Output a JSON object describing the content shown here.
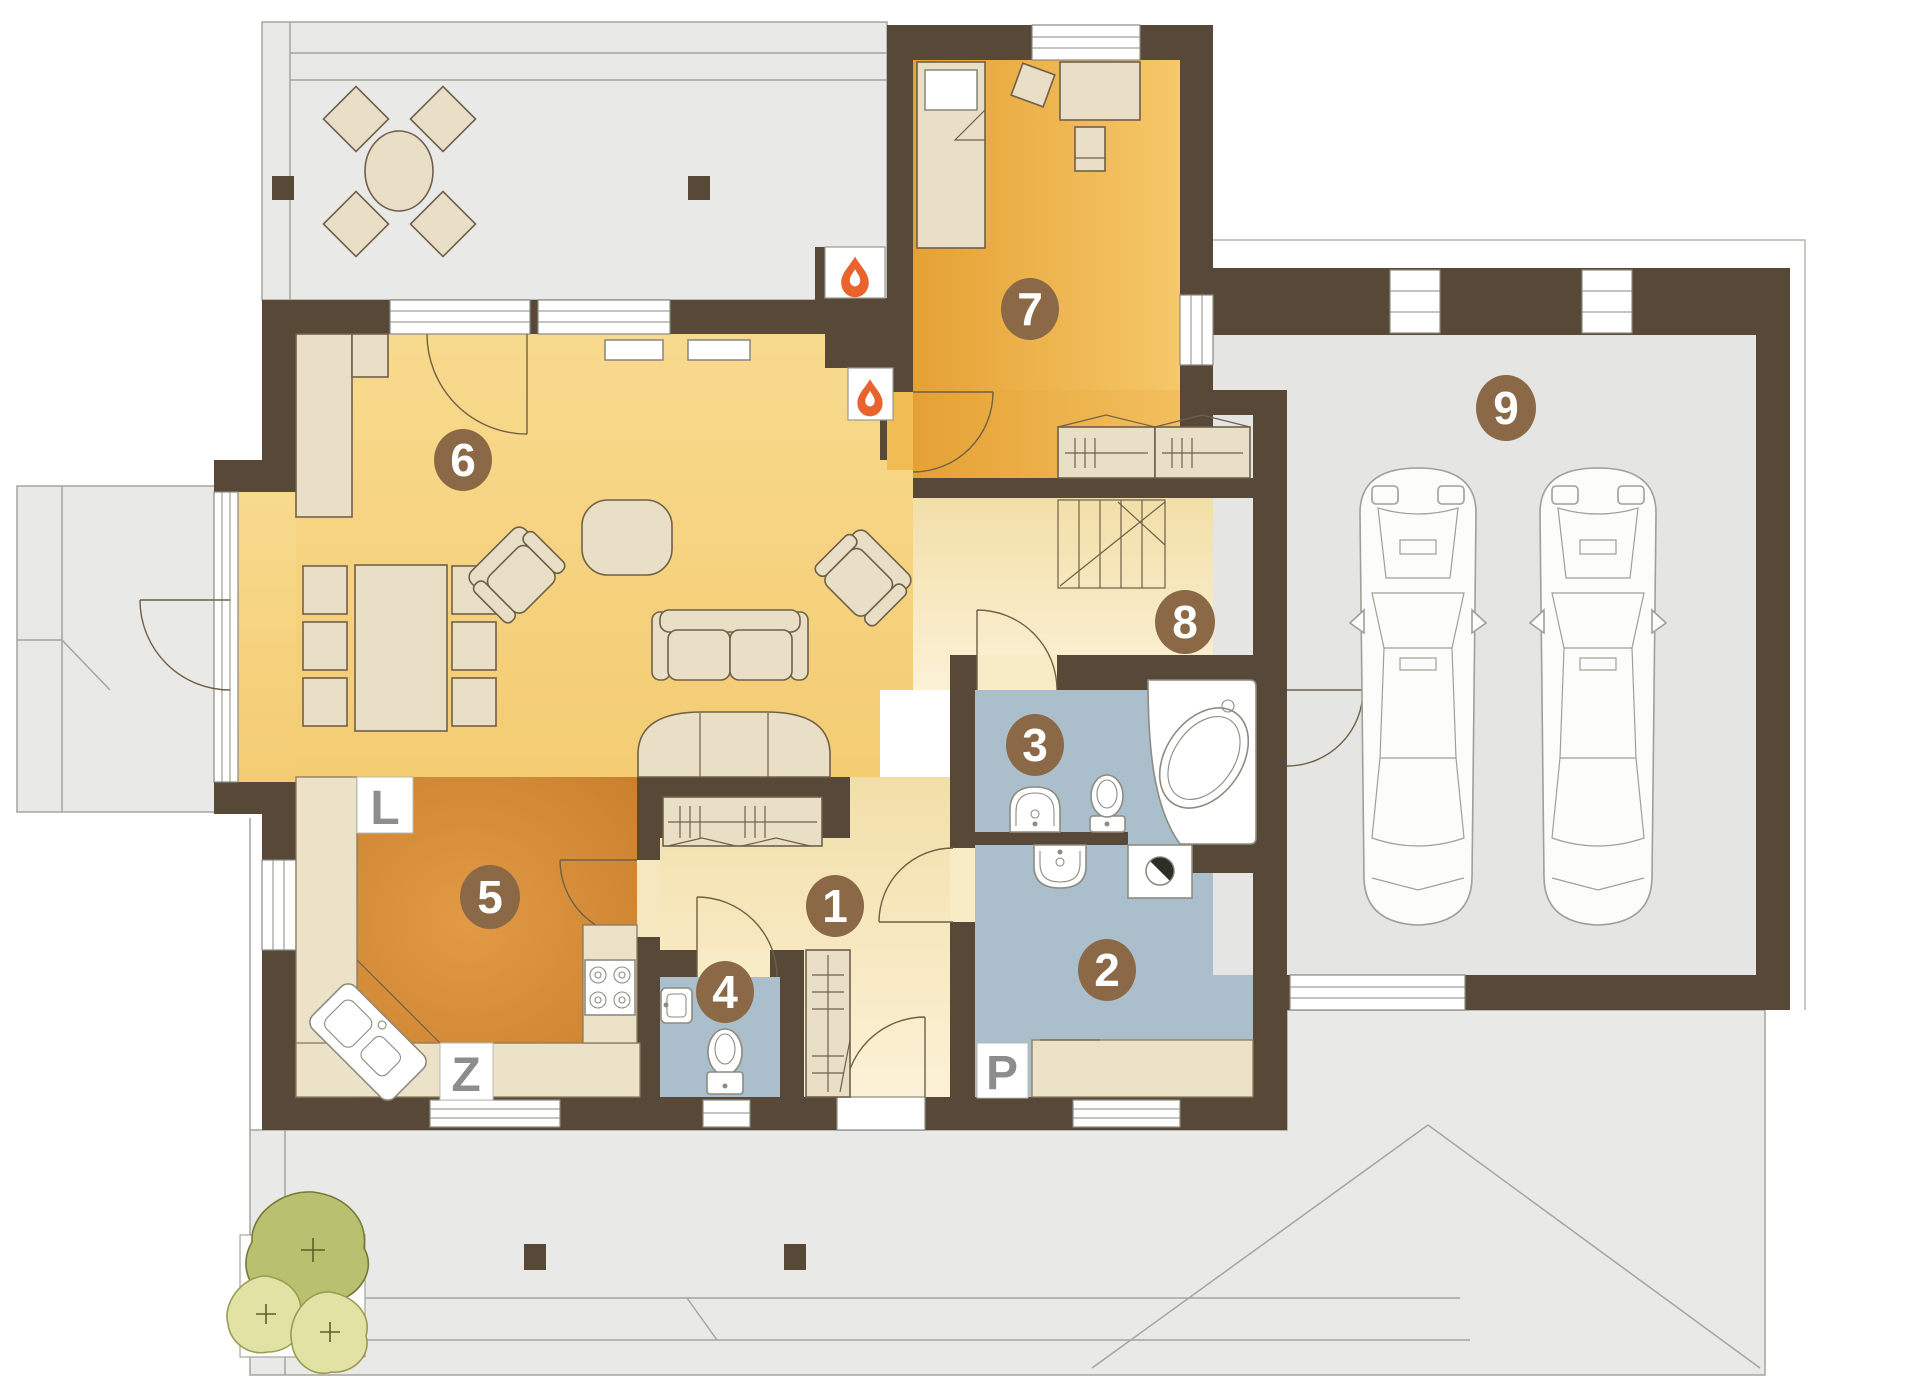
{
  "document": {
    "type": "house-floor-plan"
  },
  "rooms": [
    {
      "number": "1"
    },
    {
      "number": "2"
    },
    {
      "number": "3"
    },
    {
      "number": "4"
    },
    {
      "number": "5"
    },
    {
      "number": "6"
    },
    {
      "number": "7"
    },
    {
      "number": "8"
    },
    {
      "number": "9"
    }
  ],
  "markers": {
    "l": "L",
    "z": "Z",
    "p": "P"
  },
  "icons": [
    "flame-icon",
    "flame-icon",
    "washing-machine-icon",
    "bush-icon",
    "car-icon"
  ],
  "colors": {
    "wall": "#584838",
    "living_floor": "#f6d383",
    "kitchen_floor": "#d98f35",
    "bedroom_floor": "#efb84e",
    "hall_floor": "#f8ecc6",
    "bathroom_floor": "#abbecb",
    "exterior_floor": "#e9e9e7",
    "room_marker": "#8c6946",
    "flame": "#e9632e",
    "letter": "#8d8d8d"
  }
}
